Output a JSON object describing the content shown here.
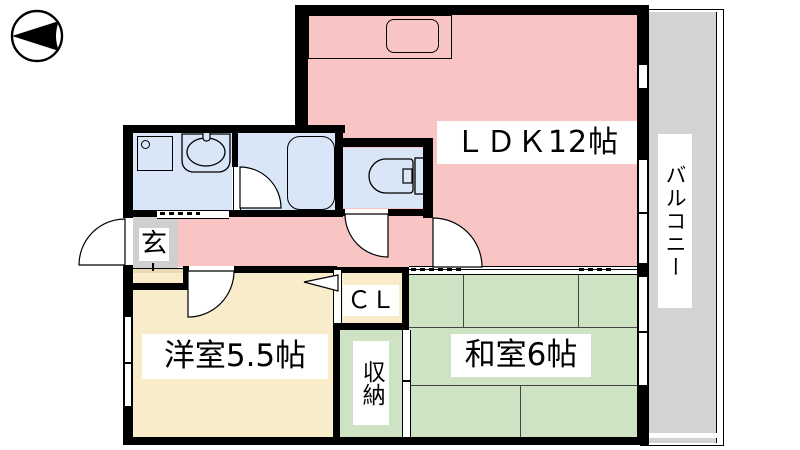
{
  "plan": {
    "type": "apartment-floor-plan",
    "compass": {
      "icon": "north-arrow",
      "points": "left"
    },
    "rooms": {
      "ldk": {
        "label": "ＬＤＫ12帖",
        "color": "#F9C5C4"
      },
      "balcony": {
        "label": "バルコニー",
        "color": "#D3D3D3"
      },
      "entrance": {
        "label": "玄",
        "color": "#CFCFCF"
      },
      "western_room": {
        "label": "洋室5.5帖",
        "color": "#F8ECCB"
      },
      "closet": {
        "label": "ＣＬ",
        "color": "#F8ECCB"
      },
      "storage": {
        "label": "収納",
        "color": "#CEE3C3"
      },
      "japanese_room": {
        "label": "和室6帖",
        "color": "#CEE3C3"
      },
      "washroom": {
        "color": "#D9E6F7"
      },
      "bathroom": {
        "color": "#D9E6F7"
      },
      "toilet": {
        "color": "#D9E6F7"
      }
    },
    "fixtures": {
      "washing_machine": "washing-machine",
      "wash_basin": "wash-basin",
      "bathtub": "bathtub",
      "toilet_bowl": "toilet",
      "kitchen_counter": "kitchen-counter-sink"
    },
    "wall_color": "#000000"
  }
}
